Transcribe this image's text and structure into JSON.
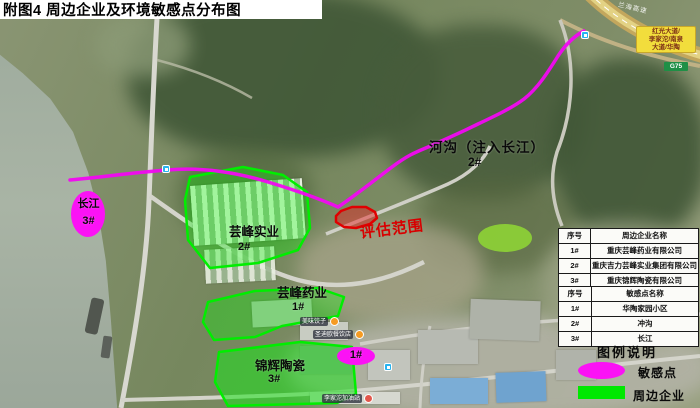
{
  "title": "附图4 周边企业及环境敏感点分布图",
  "map_labels": {
    "ditch_name": "河沟（注入长江）",
    "ditch_num": "2#",
    "yangtze_name": "长江",
    "yangtze_num": "3#",
    "shiye_name": "芸峰实业",
    "shiye_num": "2#",
    "yaoye_name": "芸峰药业",
    "yaoye_num": "1#",
    "taoci_name": "锦辉陶瓷",
    "taoci_num": "3#",
    "huatao_num": "1#",
    "assessment": "评估范围",
    "highway_name": "兰海高速",
    "road_sign_line1": "红光大道/",
    "road_sign_line2": "李家沱/南泉",
    "road_sign_line3": "大道/华陶",
    "road_shield": "G75",
    "poi_restaurant1": "美味饺子",
    "poi_restaurant2": "圣迪欧餐饮店",
    "poi_bottom": "李家沱加油站"
  },
  "enterprise_table": {
    "headers": [
      "序号",
      "周边企业名称"
    ],
    "rows": [
      [
        "1#",
        "重庆芸峰药业有限公司"
      ],
      [
        "2#",
        "重庆吉力芸峰实业集团有限公司"
      ],
      [
        "3#",
        "重庆锦辉陶瓷有限公司"
      ]
    ]
  },
  "sensitive_table": {
    "headers": [
      "序号",
      "敏感点名称"
    ],
    "rows": [
      [
        "1#",
        "华陶家园小区"
      ],
      [
        "2#",
        "冲沟"
      ],
      [
        "3#",
        "长江"
      ]
    ]
  },
  "legend": {
    "title": "图例说明",
    "sensitive_label": "敏感点",
    "enterprise_label": "周边企业"
  },
  "colors": {
    "sensitive_magenta": "#f812f0",
    "enterprise_green": "#00e800",
    "assessment_red": "#dd0000"
  }
}
